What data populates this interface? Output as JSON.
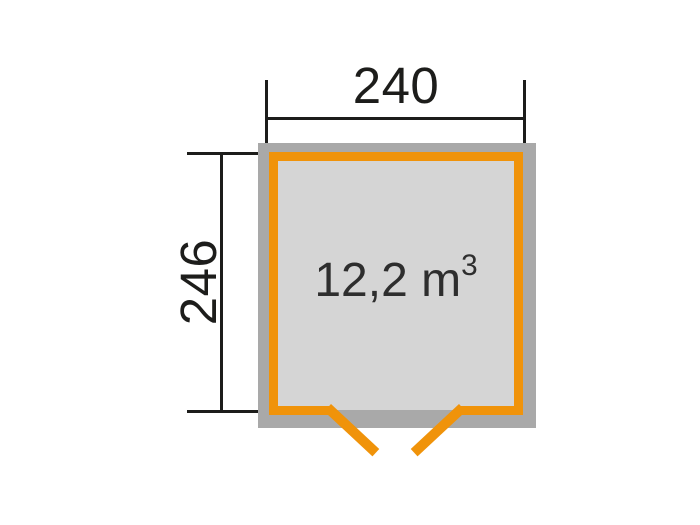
{
  "plan": {
    "title": "shed-floor-plan",
    "width_label": "240",
    "depth_label": "246",
    "volume_value": "12,2 m",
    "volume_sup": "3"
  },
  "colors": {
    "accent_orange": "#f0930a",
    "wall_gray": "#a9a9a9",
    "floor_gray": "#d5d5d5",
    "dimension_black": "#1d1d1b",
    "background": "#ffffff"
  }
}
